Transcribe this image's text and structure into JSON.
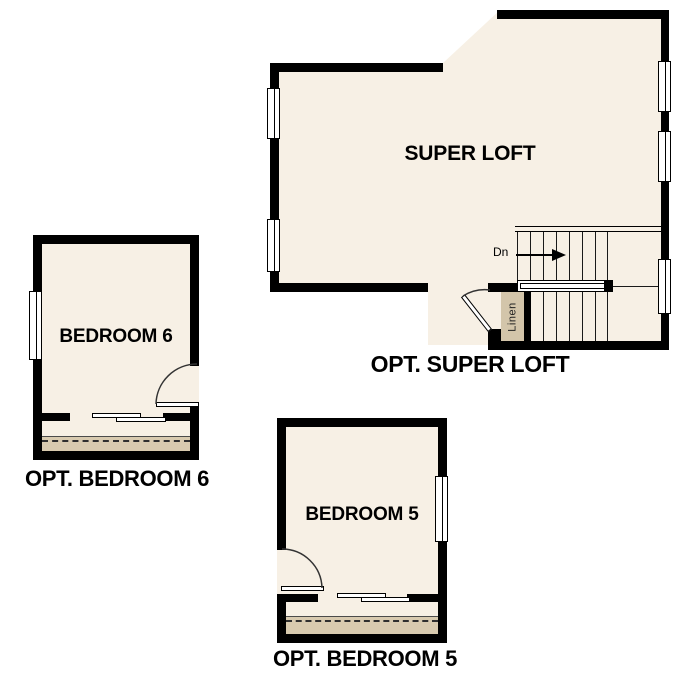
{
  "document": {
    "type": "floor-plan-options-sheet",
    "background_color": "#FFFFFF"
  },
  "colors": {
    "floor_fill": "#F7F0E5",
    "closet_strip_fill": "#D8CAAF",
    "linen_closet_fill": "#D3C5AA",
    "wall": "#000000"
  },
  "plans": {
    "super_loft": {
      "room_label": "SUPER LOFT",
      "caption": "OPT. SUPER LOFT",
      "stairs_down_label": "Dn",
      "stairs_arrow_icon": "right-arrow",
      "linen_label": "Linen"
    },
    "bedroom6": {
      "room_label": "BEDROOM 6",
      "caption": "OPT. BEDROOM 6"
    },
    "bedroom5": {
      "room_label": "BEDROOM 5",
      "caption": "OPT. BEDROOM 5"
    }
  }
}
